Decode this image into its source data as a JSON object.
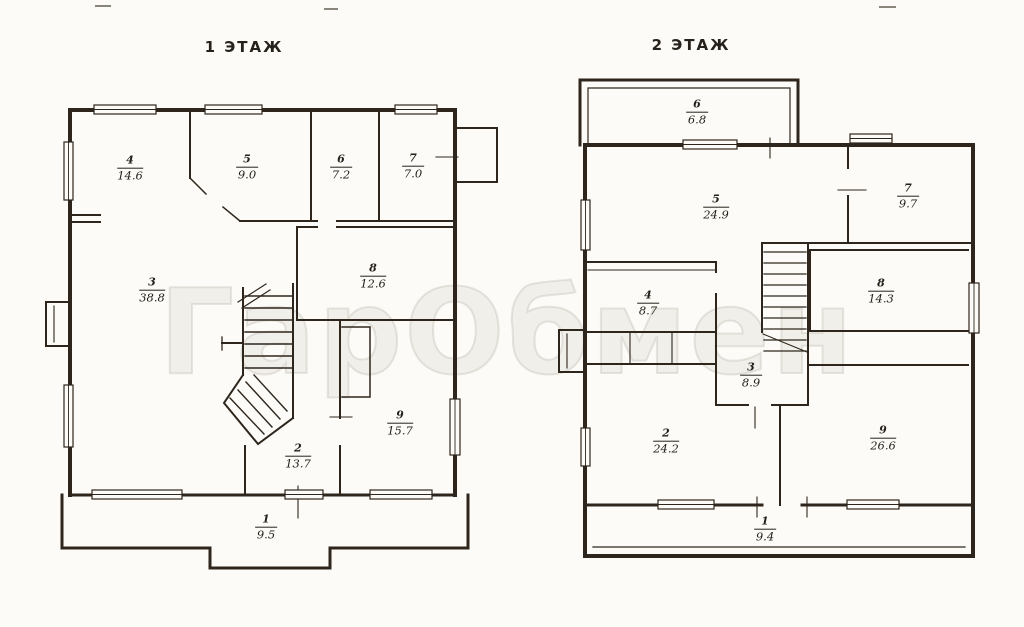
{
  "watermark": {
    "text": "ГарОбмен"
  },
  "ink_color": "#2e261c",
  "paper_color": "#fcfbf7",
  "floors": [
    {
      "title": "1 ЭТАЖ",
      "rooms": [
        {
          "num": "4",
          "area": "14.6"
        },
        {
          "num": "5",
          "area": "9.0"
        },
        {
          "num": "6",
          "area": "7.2"
        },
        {
          "num": "7",
          "area": "7.0"
        },
        {
          "num": "3",
          "area": "38.8"
        },
        {
          "num": "8",
          "area": "12.6"
        },
        {
          "num": "2",
          "area": "13.7"
        },
        {
          "num": "9",
          "area": "15.7"
        },
        {
          "num": "1",
          "area": "9.5"
        }
      ]
    },
    {
      "title": "2 ЭТАЖ",
      "rooms": [
        {
          "num": "6",
          "area": "6.8"
        },
        {
          "num": "5",
          "area": "24.9"
        },
        {
          "num": "7",
          "area": "9.7"
        },
        {
          "num": "4",
          "area": "8.7"
        },
        {
          "num": "8",
          "area": "14.3"
        },
        {
          "num": "3",
          "area": "8.9"
        },
        {
          "num": "2",
          "area": "24.2"
        },
        {
          "num": "9",
          "area": "26.6"
        },
        {
          "num": "1",
          "area": "9.4"
        }
      ]
    }
  ]
}
